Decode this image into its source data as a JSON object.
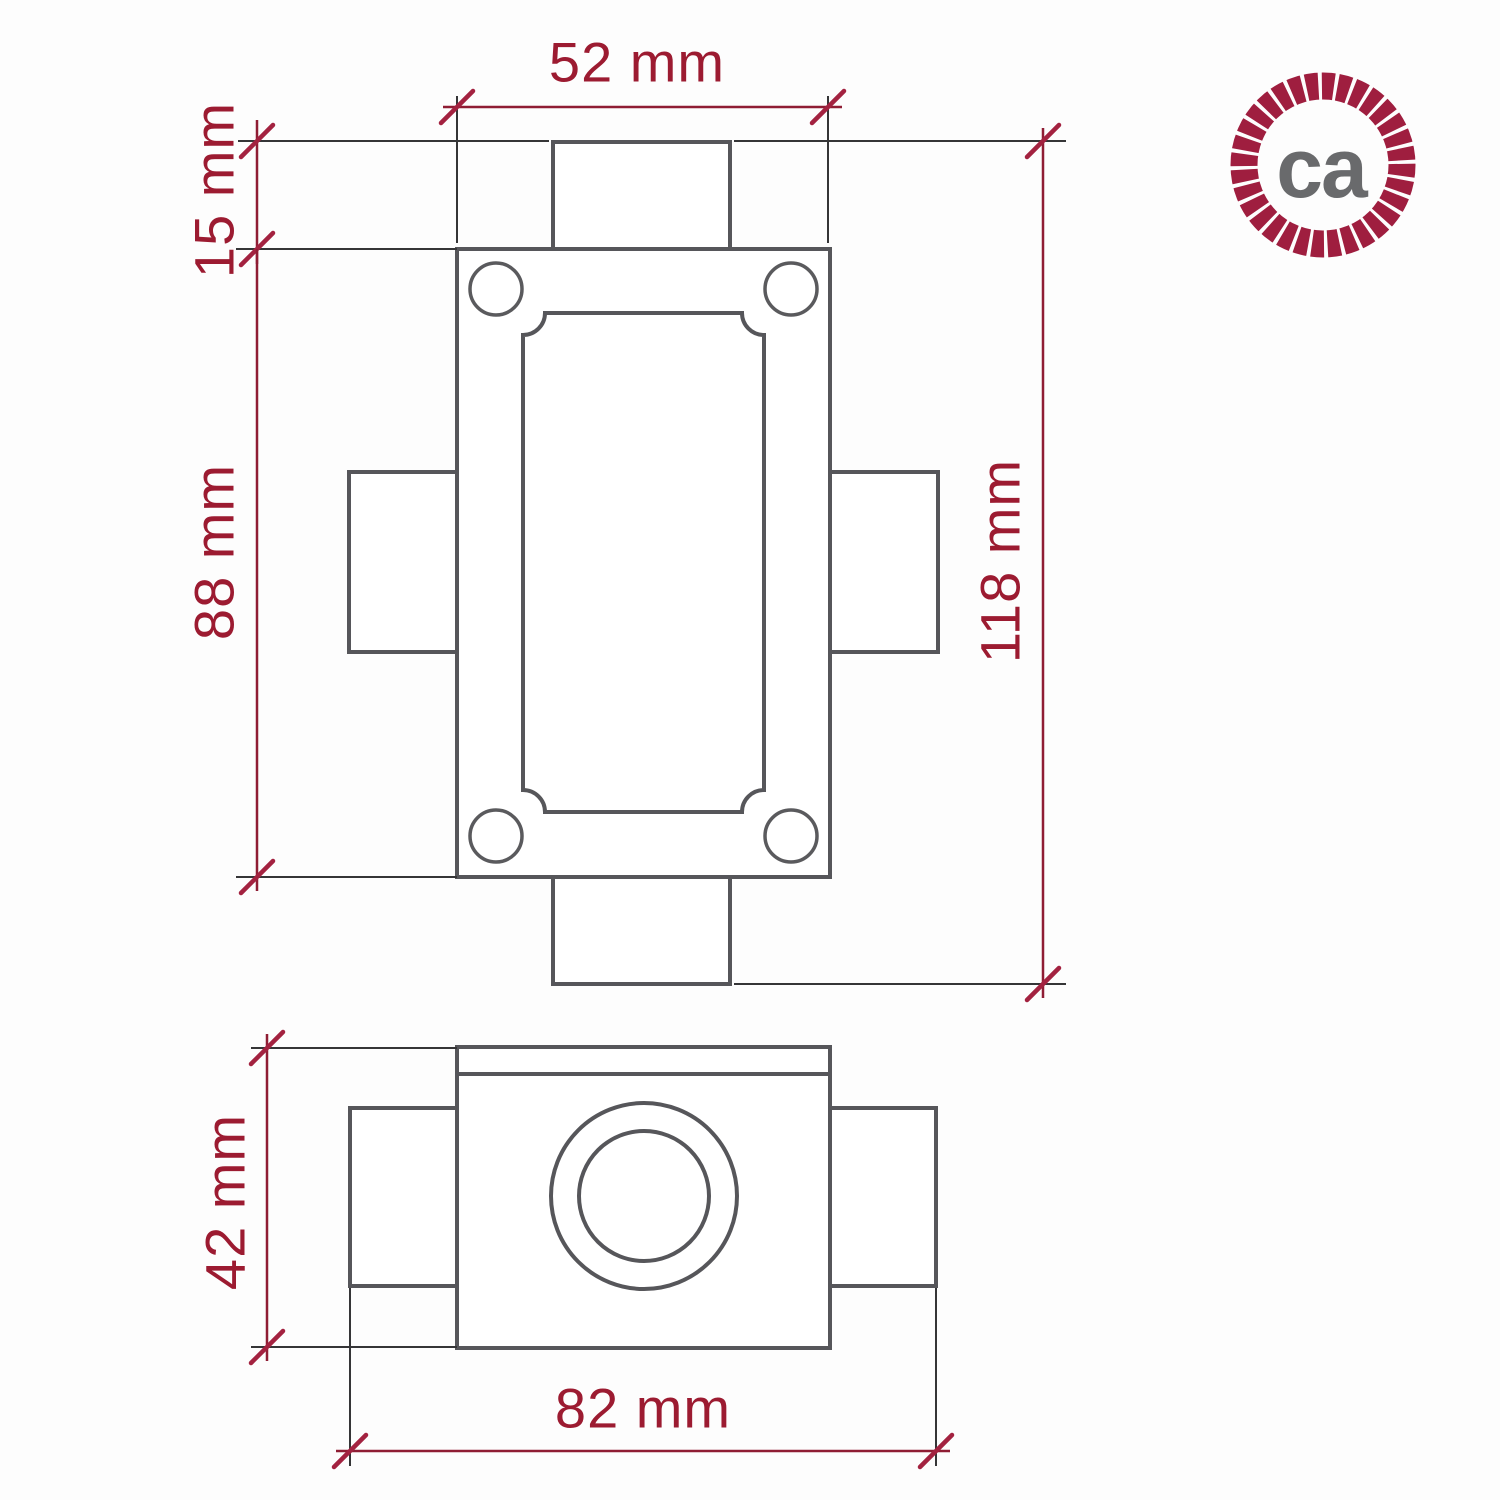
{
  "drawing": {
    "type": "technical-dimension-diagram",
    "subject": "four-way junction box with screw cover and cable entries",
    "views": {
      "front_view": {
        "dims": {
          "stub_width": "52 mm",
          "neck_height": "15 mm",
          "body_height": "88 mm",
          "overall_height": "118 mm"
        }
      },
      "side_view": {
        "dims": {
          "body_height": "42 mm",
          "overall_width": "82 mm"
        }
      }
    }
  },
  "logo": {
    "text": "ca"
  },
  "colors": {
    "dimension_red": "#8f1d34",
    "label_red": "#9c1b31",
    "tick_red": "#a32240",
    "outline_gray": "#56565a",
    "extension_dark": "#353537",
    "logo_ring": "#9f1e3f",
    "logo_text": "#696a6c",
    "background": "#fdfdfd"
  }
}
